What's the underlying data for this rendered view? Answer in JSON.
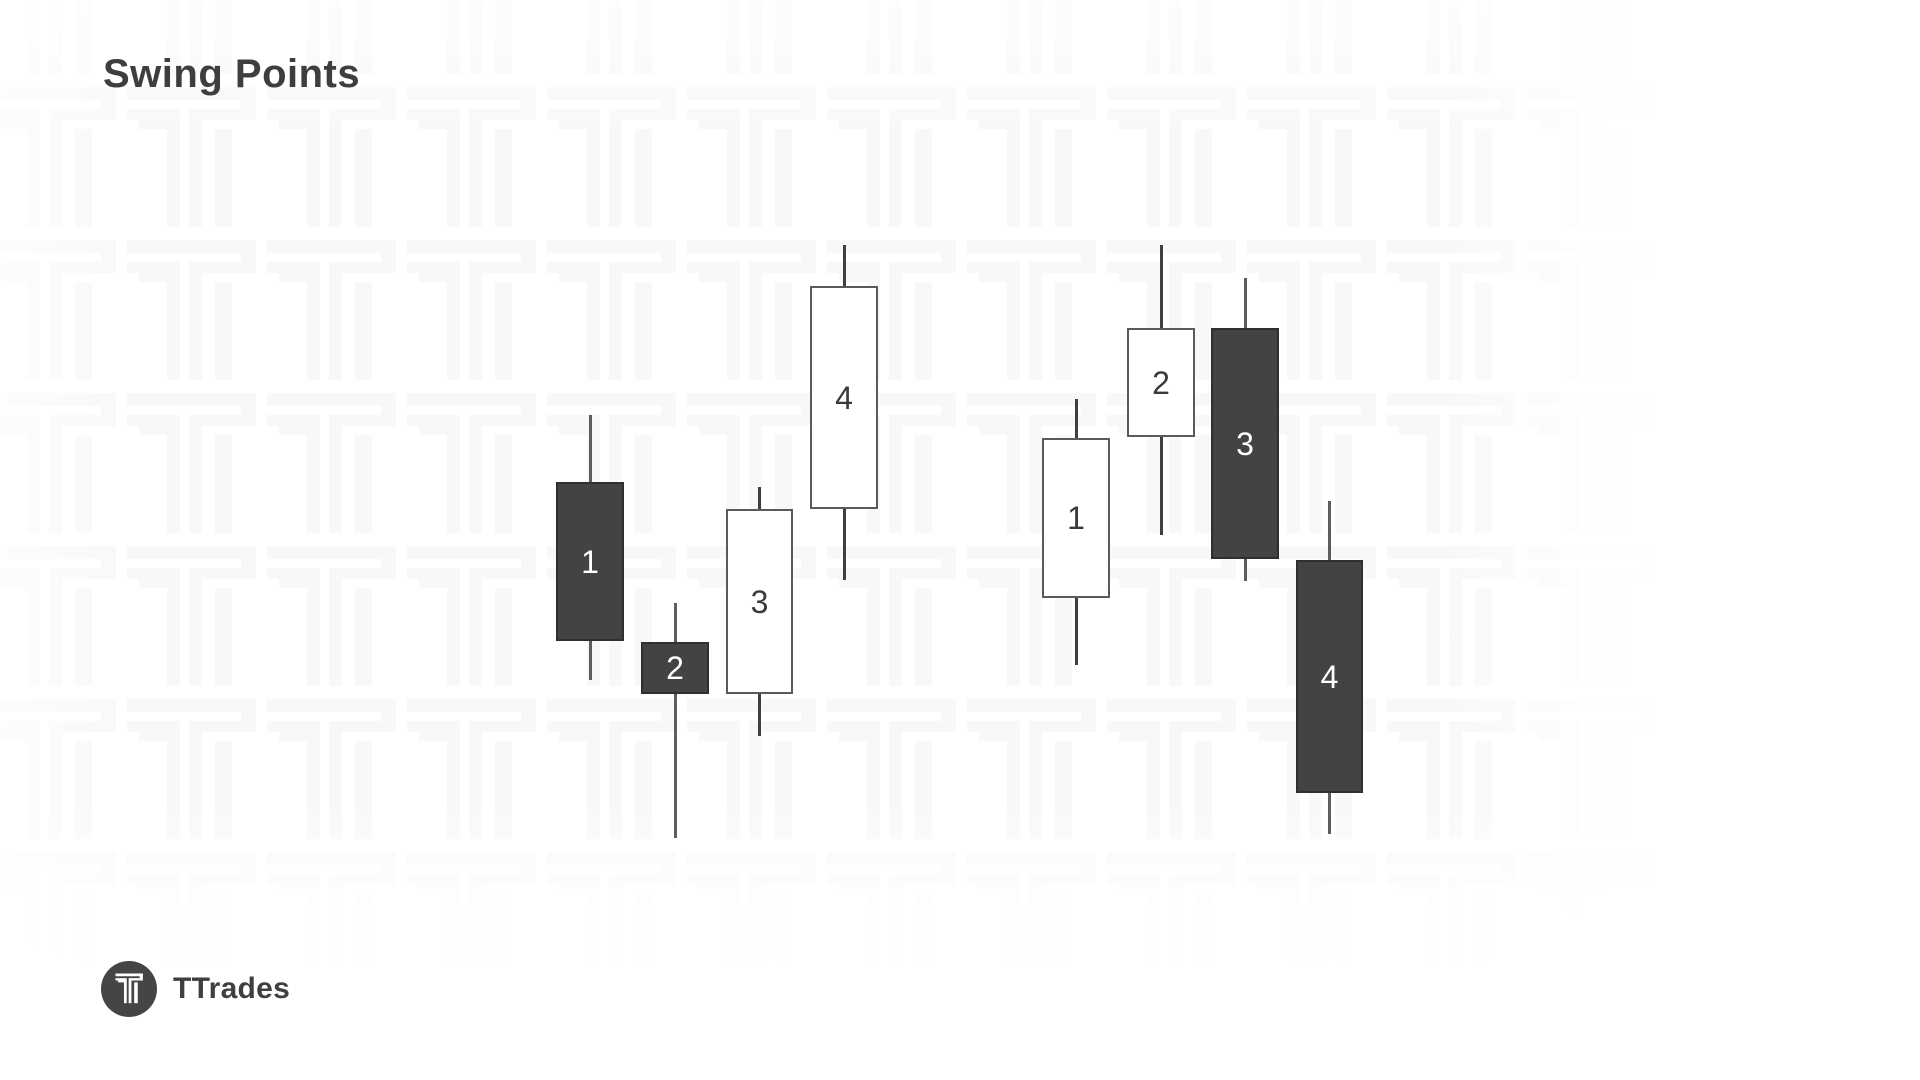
{
  "title": "Swing Points",
  "brand": {
    "name": "TTrades",
    "logo_icon": "ttrades-t-icon"
  },
  "watermark": {
    "icon": "ttrades-t-icon",
    "color": "#f8f8f8"
  },
  "colors": {
    "bearish_fill": "#434343",
    "bearish_border": "#2f2f2f",
    "bearish_wick": "#5d5d5d",
    "bullish_fill": "#ffffff",
    "bullish_border": "#5a5a5a",
    "bullish_wick": "#3f3f3f",
    "label_on_bearish": "#ffffff",
    "label_on_bullish": "#3a3a3a",
    "logo_circle": "#454545",
    "logo_glyph": "#ffffff",
    "title_color": "#3e3e3e"
  },
  "groups": [
    {
      "name": "swing-low-sequence",
      "candles": [
        {
          "label": "1",
          "type": "bearish",
          "x": 556,
          "width": 68,
          "body_top": 482,
          "body_bottom": 641,
          "wick_top": 415,
          "wick_bottom": 680
        },
        {
          "label": "2",
          "type": "bearish",
          "x": 641,
          "width": 68,
          "body_top": 642,
          "body_bottom": 694,
          "wick_top": 603,
          "wick_bottom": 838
        },
        {
          "label": "3",
          "type": "bullish",
          "x": 726,
          "width": 67,
          "body_top": 509,
          "body_bottom": 694,
          "wick_top": 487,
          "wick_bottom": 736
        },
        {
          "label": "4",
          "type": "bullish",
          "x": 810,
          "width": 68,
          "body_top": 286,
          "body_bottom": 509,
          "wick_top": 245,
          "wick_bottom": 580
        }
      ]
    },
    {
      "name": "swing-high-sequence",
      "candles": [
        {
          "label": "1",
          "type": "bullish",
          "x": 1042,
          "width": 68,
          "body_top": 438,
          "body_bottom": 598,
          "wick_top": 399,
          "wick_bottom": 665
        },
        {
          "label": "2",
          "type": "bullish",
          "x": 1127,
          "width": 68,
          "body_top": 328,
          "body_bottom": 437,
          "wick_top": 245,
          "wick_bottom": 535
        },
        {
          "label": "3",
          "type": "bearish",
          "x": 1211,
          "width": 68,
          "body_top": 328,
          "body_bottom": 559,
          "wick_top": 278,
          "wick_bottom": 581
        },
        {
          "label": "4",
          "type": "bearish",
          "x": 1296,
          "width": 67,
          "body_top": 560,
          "body_bottom": 793,
          "wick_top": 501,
          "wick_bottom": 834
        }
      ]
    }
  ]
}
